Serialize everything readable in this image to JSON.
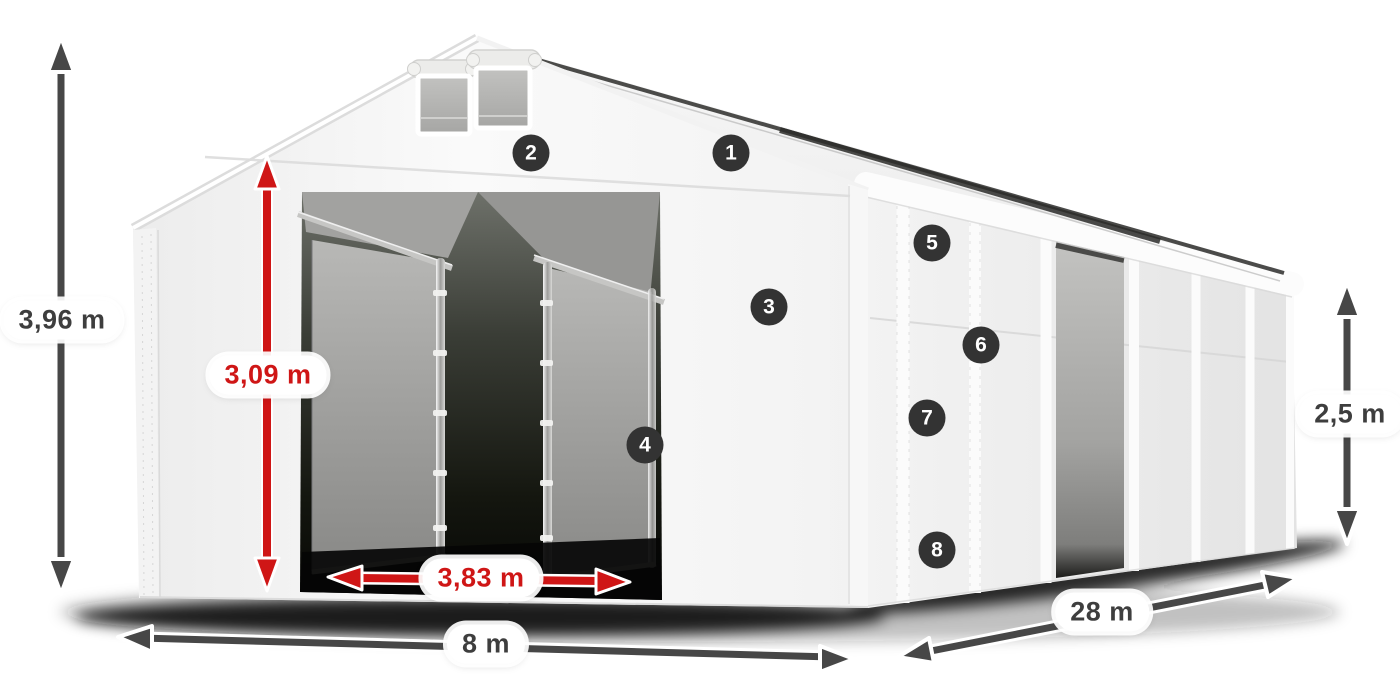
{
  "diagram": {
    "dimensions": {
      "total_height": "3,96 m",
      "door_height": "3,09 m",
      "door_width": "3,83 m",
      "front_width": "8 m",
      "length": "28 m",
      "side_height": "2,5 m"
    },
    "markers": [
      "1",
      "2",
      "3",
      "4",
      "5",
      "6",
      "7",
      "8"
    ],
    "icons": {
      "height_arrow": "double-headed-vertical-arrow",
      "width_arrow": "double-headed-horizontal-arrow",
      "length_arrow": "double-headed-diagonal-arrow",
      "door_height_arrow": "double-headed-vertical-arrow-red",
      "door_width_arrow": "double-headed-horizontal-arrow-red"
    },
    "colors": {
      "accent_red": "#cf1616",
      "arrow_dark": "#474747",
      "badge_bg": "#333333",
      "tent_white": "#f5f5f5",
      "interior_gray": "#9a9a98",
      "shadow_black": "#0b0b0b"
    }
  }
}
